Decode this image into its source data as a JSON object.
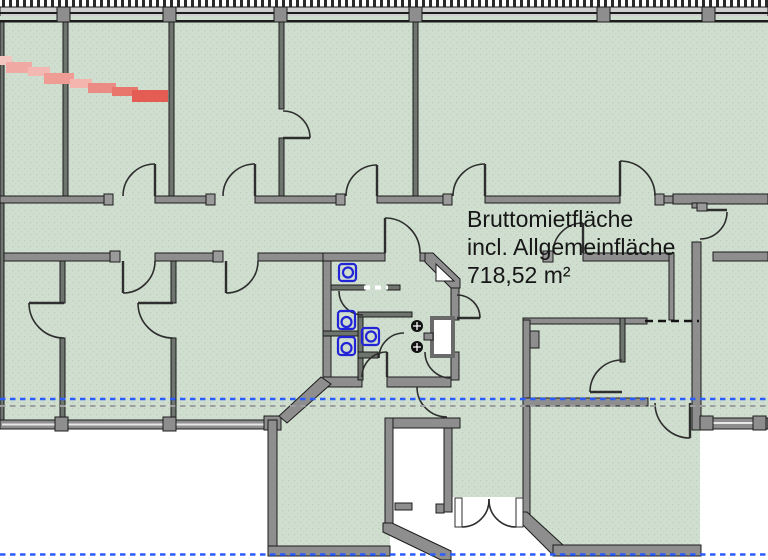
{
  "document": {
    "type": "architectural-floor-plan",
    "annotation": {
      "line1": "Bruttomietfläche",
      "line2": "incl. Allgemeinfläche",
      "line3": "718,52 m²"
    },
    "area": {
      "label": "Bruttomietfläche incl. Allgemeinfläche",
      "value": "718,52",
      "unit": "m²"
    }
  },
  "colors": {
    "paper": "#ffffff",
    "floor_tint": "#cfdecf",
    "floor_dot": "#bccfbc",
    "wall_fill": "#8e8e8e",
    "wall_outline": "#1c1c1c",
    "partition_fill": "#6e746e",
    "fixture_blue": "#2323d8",
    "drain_black": "#111111",
    "boundary_dash_blue": "#2b5cff",
    "boundary_dash_gray": "#9e9e9e",
    "hidden_edge_dash_black": "#141414",
    "threshold_dash_white": "#ffffff",
    "highlight_red": "#e45d55"
  },
  "icons": {
    "fixtures": [
      "toilet-icon",
      "toilet-icon",
      "sink-icon",
      "sink-icon",
      "floor-drain-icon",
      "floor-drain-icon",
      "duct-shaft"
    ]
  }
}
